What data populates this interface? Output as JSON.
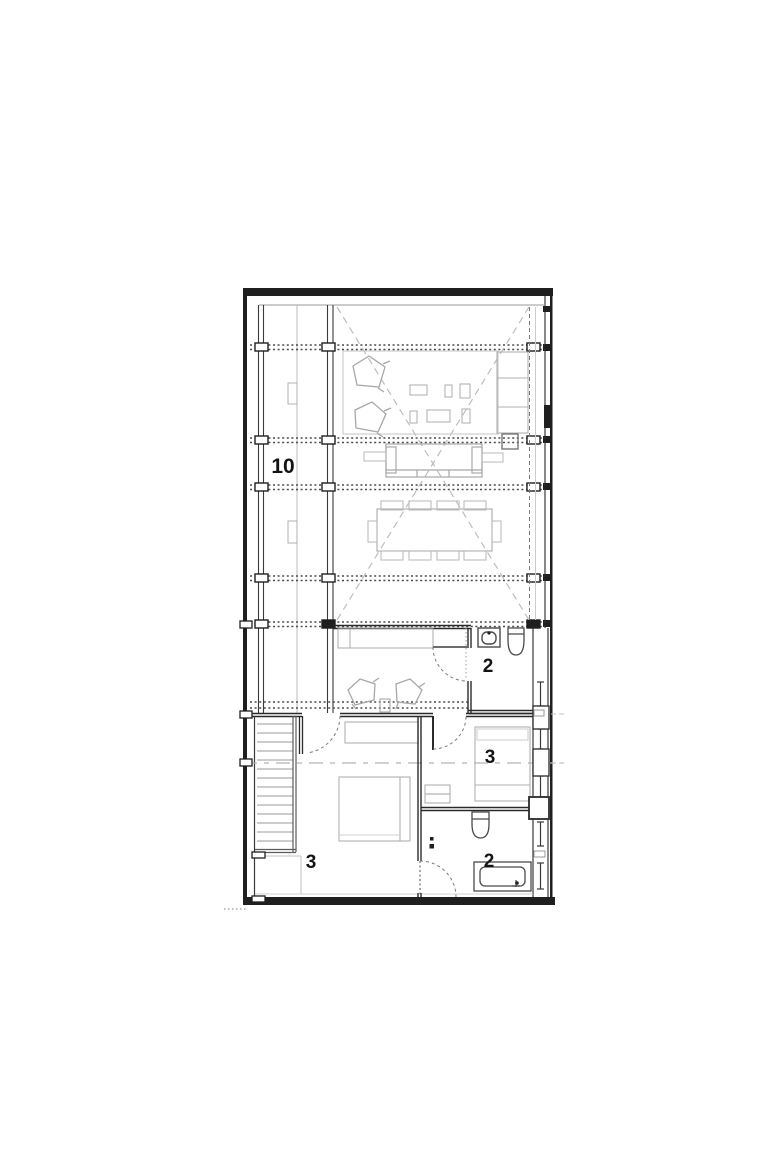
{
  "drawing": {
    "type": "architectural-floor-plan",
    "labels": {
      "terrace": "10",
      "bath_upper": "2",
      "bedroom_right": "3",
      "bedroom_left": "3",
      "bath_lower": "2"
    },
    "rooms": [
      {
        "id": "terrace-deck",
        "label": "10"
      },
      {
        "id": "bathroom-upper",
        "label": "2"
      },
      {
        "id": "bedroom-right",
        "label": "3"
      },
      {
        "id": "bedroom-left",
        "label": "3"
      },
      {
        "id": "bathroom-lower",
        "label": "2"
      }
    ],
    "colors": {
      "wall": "#2a2a2a",
      "fixture": "#4a4a4a",
      "furniture": "#a0a0a0",
      "light_line": "#c6c6c6",
      "dashed_void": "#bdbdbd",
      "section_line": "#b3b3b3",
      "background": "#ffffff"
    }
  }
}
